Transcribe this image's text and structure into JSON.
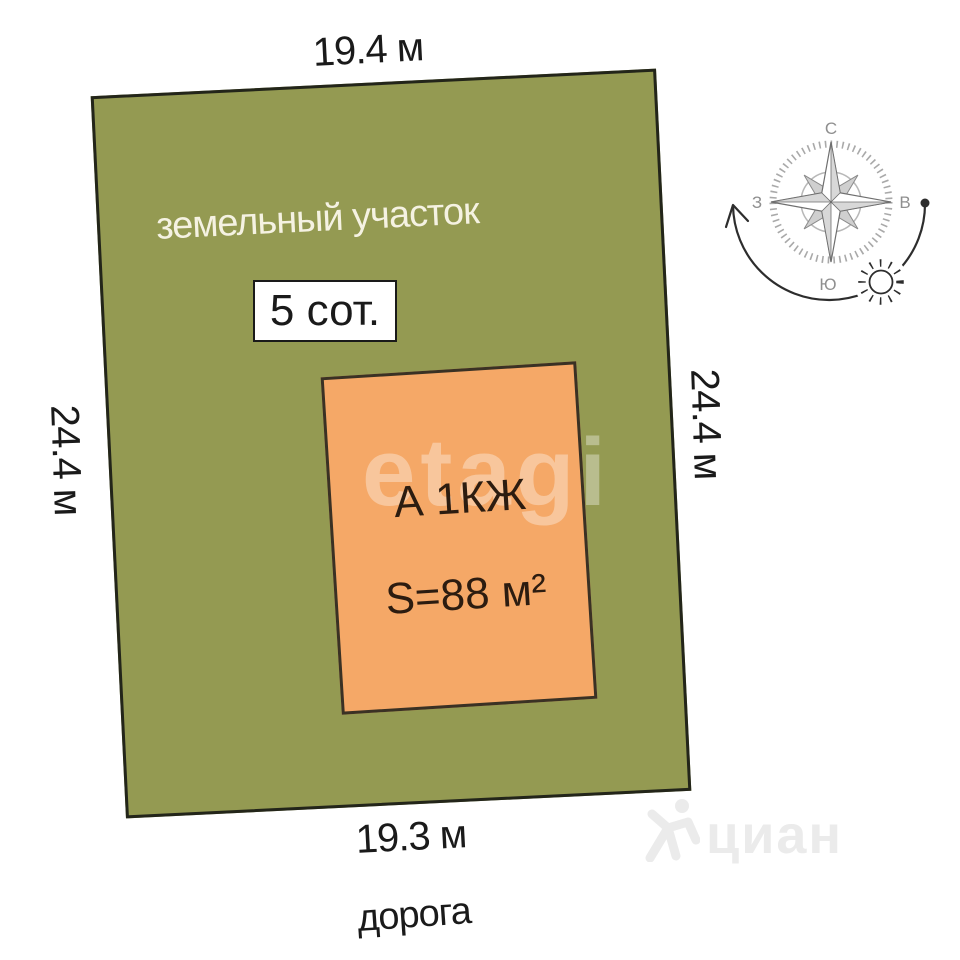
{
  "diagram": {
    "plot": {
      "label": "земельный участок",
      "area_badge": "5 сот.",
      "fill_color": "#949a52",
      "border_color": "#23251a"
    },
    "building": {
      "title": "А 1КЖ",
      "area": "S=88 м²",
      "fill_color": "#f5a867",
      "border_color": "#3a3124"
    },
    "dimensions": {
      "top": "19.4 м",
      "left": "24.4 м",
      "right": "24.4 м",
      "bottom": "19.3 м"
    },
    "road_label": "дорога"
  },
  "compass": {
    "north": "С",
    "east": "В",
    "south": "Ю",
    "west": "З",
    "icons": [
      "compass-rose-icon",
      "sun-icon",
      "sun-path-arrow-icon"
    ],
    "label_color": "#8f8f8f",
    "arrow_color": "#2d2d2d"
  },
  "watermarks": {
    "etagi": "etagi",
    "cian": "циан"
  },
  "colors": {
    "background": "#ffffff",
    "dimension_text": "#1a1a1a",
    "plot_text": "#f5f2e2",
    "building_text": "#2c1c10",
    "watermark_etagi": "rgba(255,255,255,0.35)",
    "watermark_cian": "#ebebeb"
  }
}
